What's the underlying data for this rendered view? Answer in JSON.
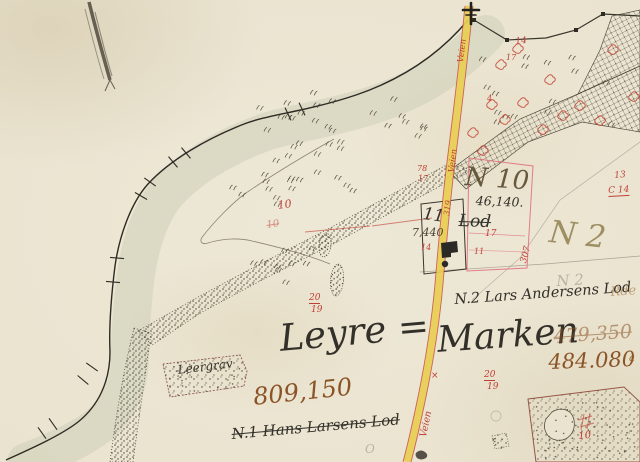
{
  "labels": {
    "region_left": "Leyre =",
    "region_right": "Marken",
    "area_total": "809,150",
    "area_old": "479,350",
    "area_new": "484.080",
    "lot1": "N.1 Hans Larsens Lod",
    "lot2": "N.2 Lars Andersens Lod",
    "parcel10_no": "N 10",
    "parcel10_area": "46,140.",
    "parcel10_struck": "Lod",
    "parcel2_no": "N 2",
    "house_no": "11",
    "house_area": "7,440",
    "clay_pit": "Leergrav"
  },
  "colors": {
    "paper": "#eae3cf",
    "ink": "#33302a",
    "red": "#c04038",
    "sepia": "#8a5426",
    "road_yellow": "#e8ce52",
    "road_edge": "#c84b4b"
  },
  "annotations": [
    {
      "t": "14",
      "x": 515,
      "y": 38,
      "s": 9,
      "r": -6,
      "c": "red"
    },
    {
      "t": "17",
      "x": 506,
      "y": 54,
      "s": 8,
      "r": 0,
      "c": "red"
    },
    {
      "t": "4",
      "x": 487,
      "y": 95,
      "s": 8,
      "r": 0,
      "c": "red"
    },
    {
      "t": "10",
      "x": 277,
      "y": 200,
      "s": 11,
      "r": -8,
      "c": "red"
    },
    {
      "t": "10",
      "x": 266,
      "y": 221,
      "s": 10,
      "r": -8,
      "c": "red",
      "cls": "strike faded"
    },
    {
      "t": "78",
      "x": 417,
      "y": 165,
      "s": 8,
      "r": 0,
      "c": "red"
    },
    {
      "t": "17",
      "x": 418,
      "y": 175,
      "s": 8,
      "r": 0,
      "c": "red"
    },
    {
      "t": "319",
      "x": 443,
      "y": 215,
      "s": 8,
      "r": -82,
      "c": "red"
    },
    {
      "t": "307",
      "x": 520,
      "y": 262,
      "s": 9,
      "r": -75,
      "c": "red"
    },
    {
      "t": "17",
      "x": 485,
      "y": 230,
      "s": 9,
      "r": 0,
      "c": "red"
    },
    {
      "t": "11",
      "x": 474,
      "y": 248,
      "s": 8,
      "r": 0,
      "c": "red"
    },
    {
      "t": "14",
      "x": 421,
      "y": 244,
      "s": 8,
      "r": 0,
      "c": "red"
    },
    {
      "t": "13",
      "x": 614,
      "y": 172,
      "s": 9,
      "r": -5,
      "c": "red"
    },
    {
      "t": "C 14",
      "x": 608,
      "y": 187,
      "s": 9,
      "r": -3,
      "c": "red",
      "cls": "u"
    },
    {
      "t": "20",
      "x": 309,
      "y": 294,
      "s": 9,
      "r": 0,
      "c": "red",
      "cls": "u"
    },
    {
      "t": "19",
      "x": 311,
      "y": 306,
      "s": 9,
      "r": 0,
      "c": "red"
    },
    {
      "t": "20",
      "x": 484,
      "y": 371,
      "s": 9,
      "r": 0,
      "c": "red",
      "cls": "u"
    },
    {
      "t": "19",
      "x": 487,
      "y": 383,
      "s": 9,
      "r": 0,
      "c": "red"
    },
    {
      "t": "10",
      "x": 578,
      "y": 432,
      "s": 10,
      "r": -5,
      "c": "red"
    },
    {
      "t": "×",
      "x": 431,
      "y": 372,
      "s": 9,
      "r": 0,
      "c": "red"
    },
    {
      "t": "Veien",
      "x": 457,
      "y": 62,
      "s": 8.5,
      "r": -83,
      "c": "red"
    },
    {
      "t": "Veien",
      "x": 448,
      "y": 172,
      "s": 8.5,
      "r": -83,
      "c": "red"
    },
    {
      "t": "Veien",
      "x": 419,
      "y": 436,
      "s": 9.5,
      "r": -78,
      "c": "red"
    },
    {
      "t": "Rde",
      "x": 610,
      "y": 286,
      "s": 13,
      "r": -4,
      "c": "sepia",
      "cls": "faded"
    },
    {
      "t": "a",
      "x": 629,
      "y": 354,
      "s": 10,
      "r": 0,
      "c": "sepia"
    },
    {
      "t": "N 2",
      "x": 556,
      "y": 274,
      "s": 15,
      "r": -3,
      "c": "pencil"
    },
    {
      "t": "O",
      "x": 365,
      "y": 443,
      "s": 12,
      "r": 0,
      "c": "pencil"
    }
  ],
  "decor": {
    "red_marks": [
      [
        489,
        102
      ],
      [
        502,
        117
      ],
      [
        515,
        46
      ],
      [
        547,
        77
      ],
      [
        577,
        103
      ],
      [
        610,
        47
      ],
      [
        631,
        94
      ],
      [
        540,
        127
      ],
      [
        560,
        113
      ],
      [
        470,
        130
      ],
      [
        480,
        148
      ],
      [
        597,
        118
      ],
      [
        520,
        100
      ],
      [
        498,
        62
      ]
    ],
    "red_lines": [
      [
        305,
        232,
        370,
        226
      ],
      [
        372,
        226,
        432,
        218
      ],
      [
        578,
        420,
        592,
        416
      ],
      [
        580,
        427,
        594,
        423
      ],
      [
        584,
        414,
        581,
        430
      ],
      [
        590,
        413,
        587,
        429
      ]
    ],
    "bank_ticks": [
      [
        302,
        109,
        -25
      ],
      [
        288,
        114,
        -25
      ],
      [
        186,
        153,
        -40
      ],
      [
        173,
        162,
        -40
      ],
      [
        150,
        182,
        -55
      ],
      [
        141,
        196,
        -60
      ],
      [
        117,
        258,
        -85
      ],
      [
        113,
        282,
        -85
      ],
      [
        92,
        367,
        -55
      ],
      [
        83,
        380,
        -50
      ],
      [
        53,
        424,
        -35
      ],
      [
        42,
        433,
        -35
      ]
    ],
    "tuft_zones": [
      {
        "x": 255,
        "y": 92,
        "w": 170,
        "h": 55,
        "n": 24
      },
      {
        "x": 215,
        "y": 148,
        "w": 140,
        "h": 60,
        "n": 20
      },
      {
        "x": 248,
        "y": 250,
        "w": 80,
        "h": 36,
        "n": 9
      },
      {
        "x": 470,
        "y": 55,
        "w": 145,
        "h": 75,
        "n": 16
      }
    ],
    "dot_zones": [
      {
        "x": 536,
        "y": 402,
        "w": 100,
        "h": 56,
        "n": 55
      },
      {
        "x": 168,
        "y": 360,
        "w": 74,
        "h": 32,
        "n": 26
      },
      {
        "x": 493,
        "y": 437,
        "w": 14,
        "h": 12,
        "n": 6
      }
    ]
  }
}
